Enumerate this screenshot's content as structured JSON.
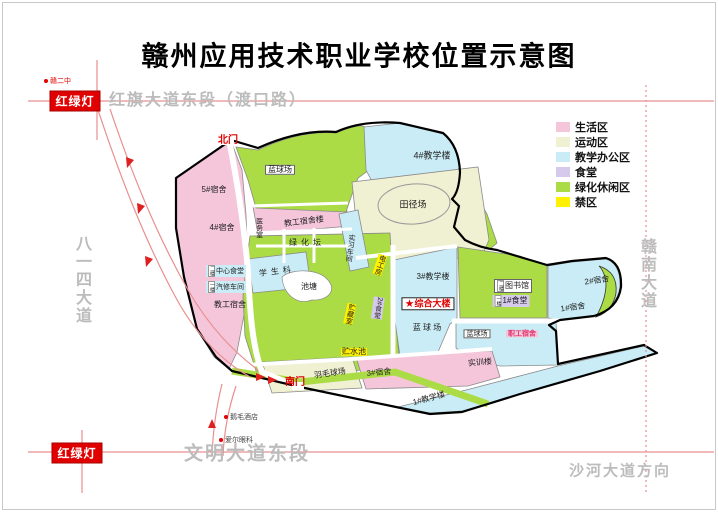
{
  "title": "赣州应用技术职业学校位置示意图",
  "colors": {
    "living": "#f5c6da",
    "sports": "#f0f0d2",
    "teaching": "#c9ecf6",
    "canteen": "#d5c9ec",
    "green": "#abdb45",
    "forbidden": "#fff100",
    "road": "#e89090",
    "road_dark": "#e02020",
    "gray_text": "#bcbcbc",
    "gate_red": "#e00000",
    "pink_text": "#e0356e"
  },
  "legend": {
    "items": [
      {
        "name": "legend-living",
        "label": "生活区",
        "color_key": "living"
      },
      {
        "name": "legend-sports",
        "label": "运动区",
        "color_key": "sports"
      },
      {
        "name": "legend-teaching",
        "label": "教学办公区",
        "color_key": "teaching"
      },
      {
        "name": "legend-canteen",
        "label": "食堂",
        "color_key": "canteen"
      },
      {
        "name": "legend-green",
        "label": "绿化休闲区",
        "color_key": "green"
      },
      {
        "name": "legend-forbidden",
        "label": "禁区",
        "color_key": "forbidden"
      }
    ]
  },
  "roads": {
    "labels": [
      {
        "name": "road-hongqi-avenue",
        "text": "红旗大道东段（渡口路）",
        "x": 208,
        "y": 98,
        "fs": 16,
        "vertical": false
      },
      {
        "name": "road-bayisi-avenue",
        "text": "八一四大道",
        "x": 81,
        "y": 280,
        "fs": 16,
        "vertical": true
      },
      {
        "name": "road-gannan-avenue",
        "text": "赣南大道",
        "x": 646,
        "y": 274,
        "fs": 16,
        "vertical": true
      },
      {
        "name": "road-wenming-avenue",
        "text": "文明大道东段",
        "x": 247,
        "y": 452,
        "fs": 19,
        "vertical": false
      },
      {
        "name": "road-shahe-direction",
        "text": "沙河大道方向",
        "x": 620,
        "y": 470,
        "fs": 15,
        "vertical": false
      }
    ]
  },
  "traffic_lights": [
    {
      "name": "traffic-light-north",
      "text": "红绿灯",
      "x": 75,
      "y": 101
    },
    {
      "name": "traffic-light-south",
      "text": "红绿灯",
      "x": 77,
      "y": 453
    }
  ],
  "landmarks": [
    {
      "name": "landmark-gan-no2-school",
      "text": "赣二中",
      "x": 44,
      "y": 81
    },
    {
      "name": "landmark-emao-hotel",
      "text": "鹅毛酒店",
      "x": 224,
      "y": 417
    },
    {
      "name": "landmark-aier-eye",
      "text": "爱尔眼科",
      "x": 219,
      "y": 440
    }
  ],
  "map": {
    "labels": [
      {
        "name": "north-gate",
        "text": "北门",
        "x": 228,
        "y": 141,
        "cls": "red",
        "fs": 10
      },
      {
        "name": "basketball-court-north",
        "text": "蓝球场",
        "x": 280,
        "y": 170,
        "cls": "wbox",
        "fs": 8
      },
      {
        "name": "teaching-building-4",
        "text": "4#教学楼",
        "x": 432,
        "y": 156,
        "fs": 9
      },
      {
        "name": "track-field",
        "text": "田径场",
        "x": 413,
        "y": 205,
        "fs": 9
      },
      {
        "name": "dorm-5",
        "text": "5#宿舍",
        "x": 214,
        "y": 190,
        "fs": 8
      },
      {
        "name": "dorm-4",
        "text": "4#宿舍",
        "x": 222,
        "y": 228,
        "fs": 8
      },
      {
        "name": "clinic",
        "text": "医务室",
        "x": 259,
        "y": 228,
        "cls": "v",
        "fs": 7
      },
      {
        "name": "staff-dorm-building",
        "text": "教工宿舍楼",
        "x": 304,
        "y": 222,
        "rot": -7,
        "fs": 8
      },
      {
        "name": "green-terrace",
        "text": "绿化坛",
        "x": 307,
        "y": 243,
        "cls": "spread",
        "fs": 8
      },
      {
        "name": "practice-workshop",
        "text": "实习车间",
        "x": 350,
        "y": 248,
        "cls": "v",
        "rot": 8,
        "fs": 7
      },
      {
        "name": "electrician-room",
        "text": "电工房",
        "x": 380,
        "y": 265,
        "cls": "ybox v",
        "rot": 18,
        "fs": 7
      },
      {
        "name": "central-canteen",
        "text": "中心食堂",
        "x": 226,
        "y": 271,
        "cls": "cybox",
        "fs": 7,
        "prefix": "二楼"
      },
      {
        "name": "auto-repair-workshop",
        "text": "汽修车间",
        "x": 226,
        "y": 287,
        "cls": "cybox",
        "fs": 7,
        "prefix": "一楼"
      },
      {
        "name": "staff-dorm",
        "text": "教工宿舍",
        "x": 230,
        "y": 305,
        "fs": 8
      },
      {
        "name": "student-affairs-office",
        "text": "学生科",
        "x": 277,
        "y": 272,
        "cls": "spread",
        "rot": -7,
        "fs": 8
      },
      {
        "name": "pond",
        "text": "池塘",
        "x": 309,
        "y": 287,
        "fs": 8
      },
      {
        "name": "teaching-building-3",
        "text": "3#教学楼",
        "x": 433,
        "y": 277,
        "fs": 8
      },
      {
        "name": "main-building",
        "text": "综合大楼",
        "x": 428,
        "y": 304,
        "cls": "starbox",
        "fs": 9,
        "star": "★"
      },
      {
        "name": "basketball-court-central",
        "text": "蓝 球 场",
        "x": 427,
        "y": 328,
        "fs": 8
      },
      {
        "name": "canteen-2",
        "text": "2#食堂",
        "x": 378,
        "y": 308,
        "cls": "lvbox v",
        "rot": 8,
        "fs": 7
      },
      {
        "name": "storage-room",
        "text": "贮藏室",
        "x": 350,
        "y": 314,
        "cls": "ybox v",
        "rot": 12,
        "fs": 7
      },
      {
        "name": "water-pool",
        "text": "贮水池",
        "x": 354,
        "y": 352,
        "cls": "ybox",
        "fs": 8
      },
      {
        "name": "badminton-court",
        "text": "羽毛球场",
        "x": 330,
        "y": 374,
        "rot": -8,
        "fs": 8
      },
      {
        "name": "dorm-3",
        "text": "3#宿舍",
        "x": 379,
        "y": 373,
        "rot": -5,
        "fs": 8
      },
      {
        "name": "south-gate",
        "text": "南门",
        "x": 295,
        "y": 383,
        "cls": "red",
        "fs": 10
      },
      {
        "name": "teaching-building-1",
        "text": "1#教学楼",
        "x": 429,
        "y": 399,
        "rot": -15,
        "fs": 8
      },
      {
        "name": "training-building",
        "text": "实训楼",
        "x": 480,
        "y": 363,
        "rot": -5,
        "fs": 8
      },
      {
        "name": "basketball-court-se",
        "text": "蓝球场",
        "x": 477,
        "y": 334,
        "cls": "wbox",
        "fs": 7
      },
      {
        "name": "staff-dorm-se",
        "text": "职工宿舍",
        "x": 522,
        "y": 334,
        "cls": "pkbox",
        "fs": 7
      },
      {
        "name": "library",
        "text": "图书馆",
        "x": 513,
        "y": 286,
        "cls": "wbox",
        "fs": 8,
        "prefix": "二楼"
      },
      {
        "name": "canteen-1",
        "text": "1#食堂",
        "x": 511,
        "y": 301,
        "cls": "lvbox",
        "fs": 8,
        "prefix": "一楼"
      },
      {
        "name": "dorm-1",
        "text": "1#宿舍",
        "x": 573,
        "y": 308,
        "rot": -8,
        "fs": 8
      },
      {
        "name": "dorm-2",
        "text": "2#宿舍",
        "x": 597,
        "y": 281,
        "rot": -8,
        "fs": 8
      }
    ]
  }
}
